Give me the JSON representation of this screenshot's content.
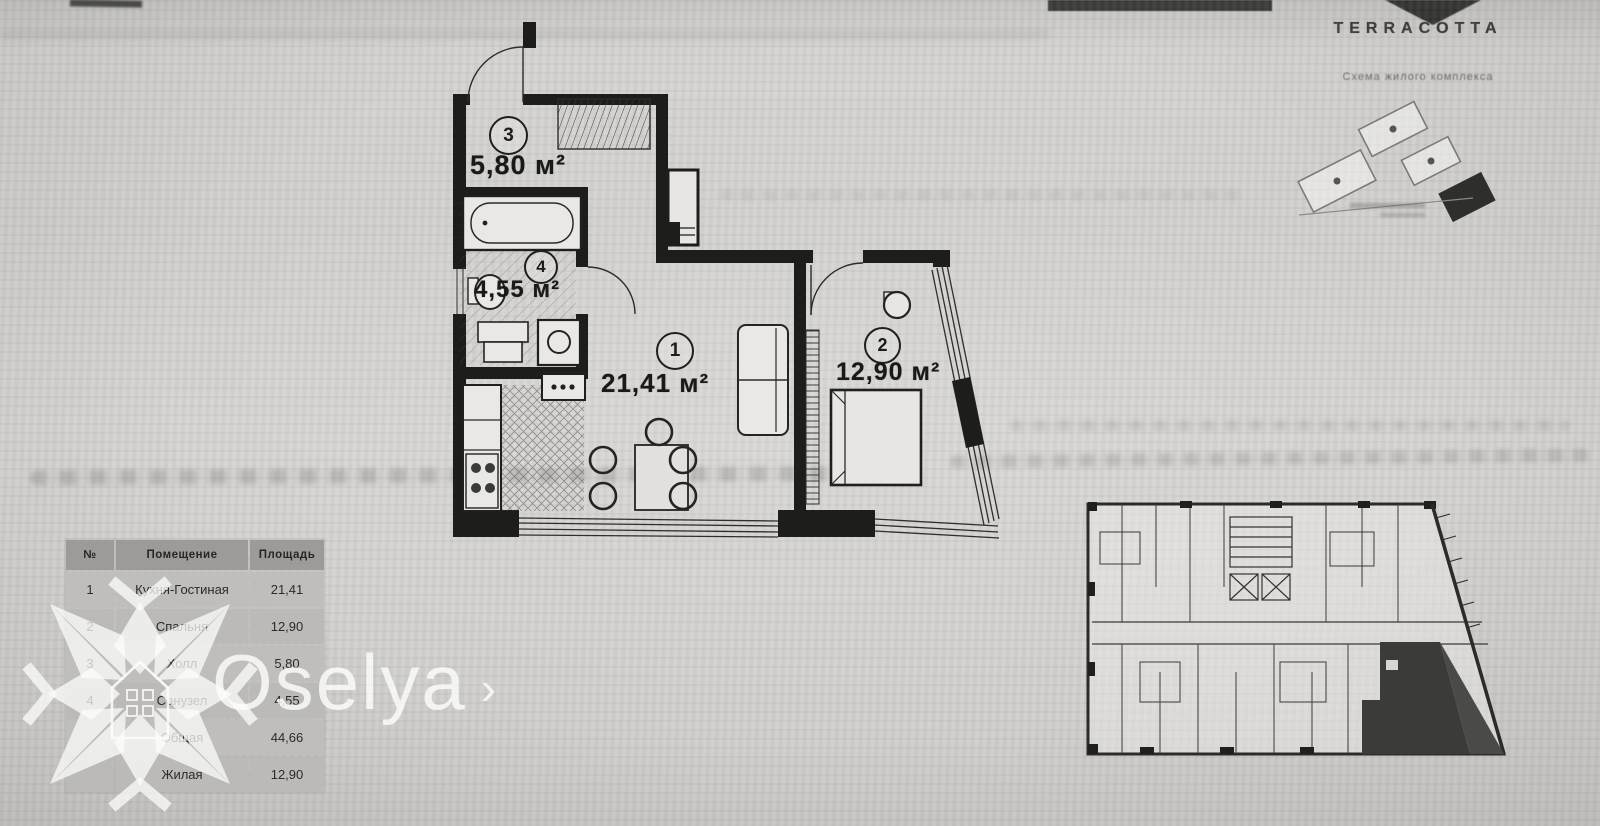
{
  "brand": {
    "name": "TERRACOTTA",
    "subtitle": "Схема жилого комплекса"
  },
  "watermark": {
    "name": "Oselya",
    "chevron": "›"
  },
  "plan": {
    "rooms": [
      {
        "number": "1",
        "area": "21,41 м²"
      },
      {
        "number": "2",
        "area": "12,90 м²"
      },
      {
        "number": "3",
        "area": "5,80 м²"
      },
      {
        "number": "4",
        "area": "4,55 м²"
      }
    ]
  },
  "table": {
    "headers": [
      "№",
      "Помещение",
      "Площадь"
    ],
    "rows": [
      [
        "1",
        "Кухня-Гостиная",
        "21,41"
      ],
      [
        "2",
        "Спальня",
        "12,90"
      ],
      [
        "3",
        "Холл",
        "5,80"
      ],
      [
        "4",
        "Санузел",
        "4,55"
      ],
      [
        "",
        "Общая",
        "44,66"
      ],
      [
        "",
        "Жилая",
        "12,90"
      ]
    ]
  }
}
